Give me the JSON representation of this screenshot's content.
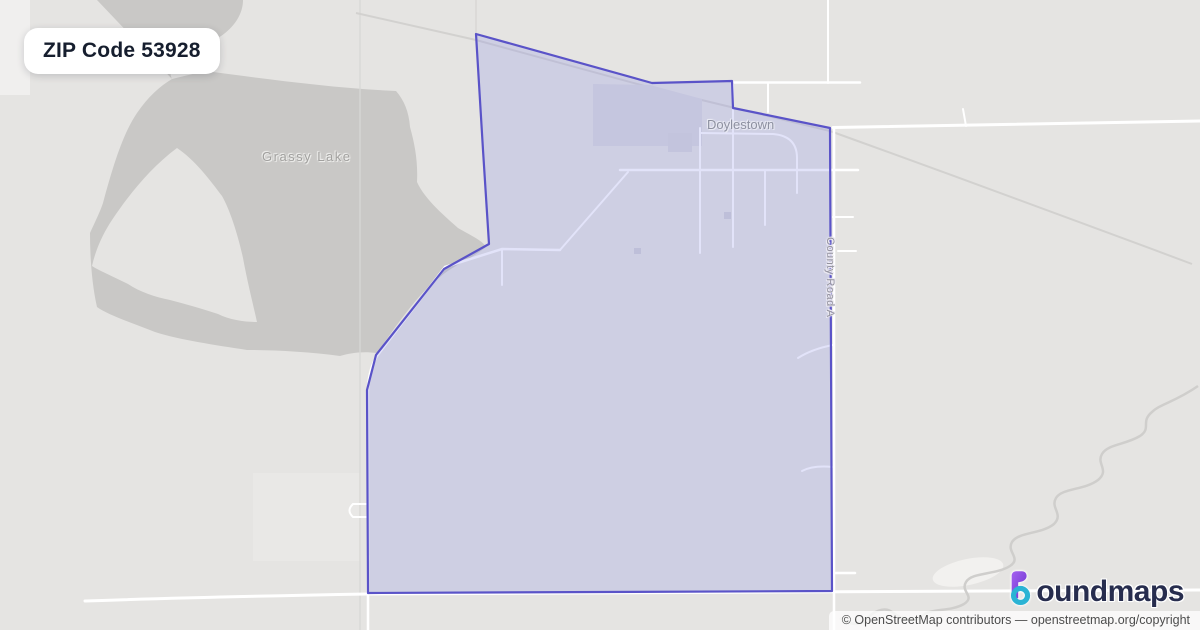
{
  "badge": {
    "label": "ZIP Code 53928"
  },
  "map_labels": {
    "lake": "Grassy Lake",
    "town": "Doylestown",
    "road": "County Road A"
  },
  "logo": {
    "brand": "boundmaps",
    "brand_rest": "oundmaps"
  },
  "attribution": {
    "text": "© OpenStreetMap contributors — openstreetmap.org/copyright"
  },
  "colors": {
    "map_background": "#e5e4e2",
    "lake_fill": "#c9c8c6",
    "zip_boundary_stroke": "#5a53c8",
    "zip_boundary_fill": "rgba(140,145,230,0.25)",
    "road": "#ffffff",
    "railway": "#d2d1cf",
    "badge_text": "#161e2e",
    "logo_navy": "#272d4e",
    "logo_purple": "#8b45e0",
    "logo_teal": "#2bb3d4",
    "label_gray": "#a1a09e"
  }
}
